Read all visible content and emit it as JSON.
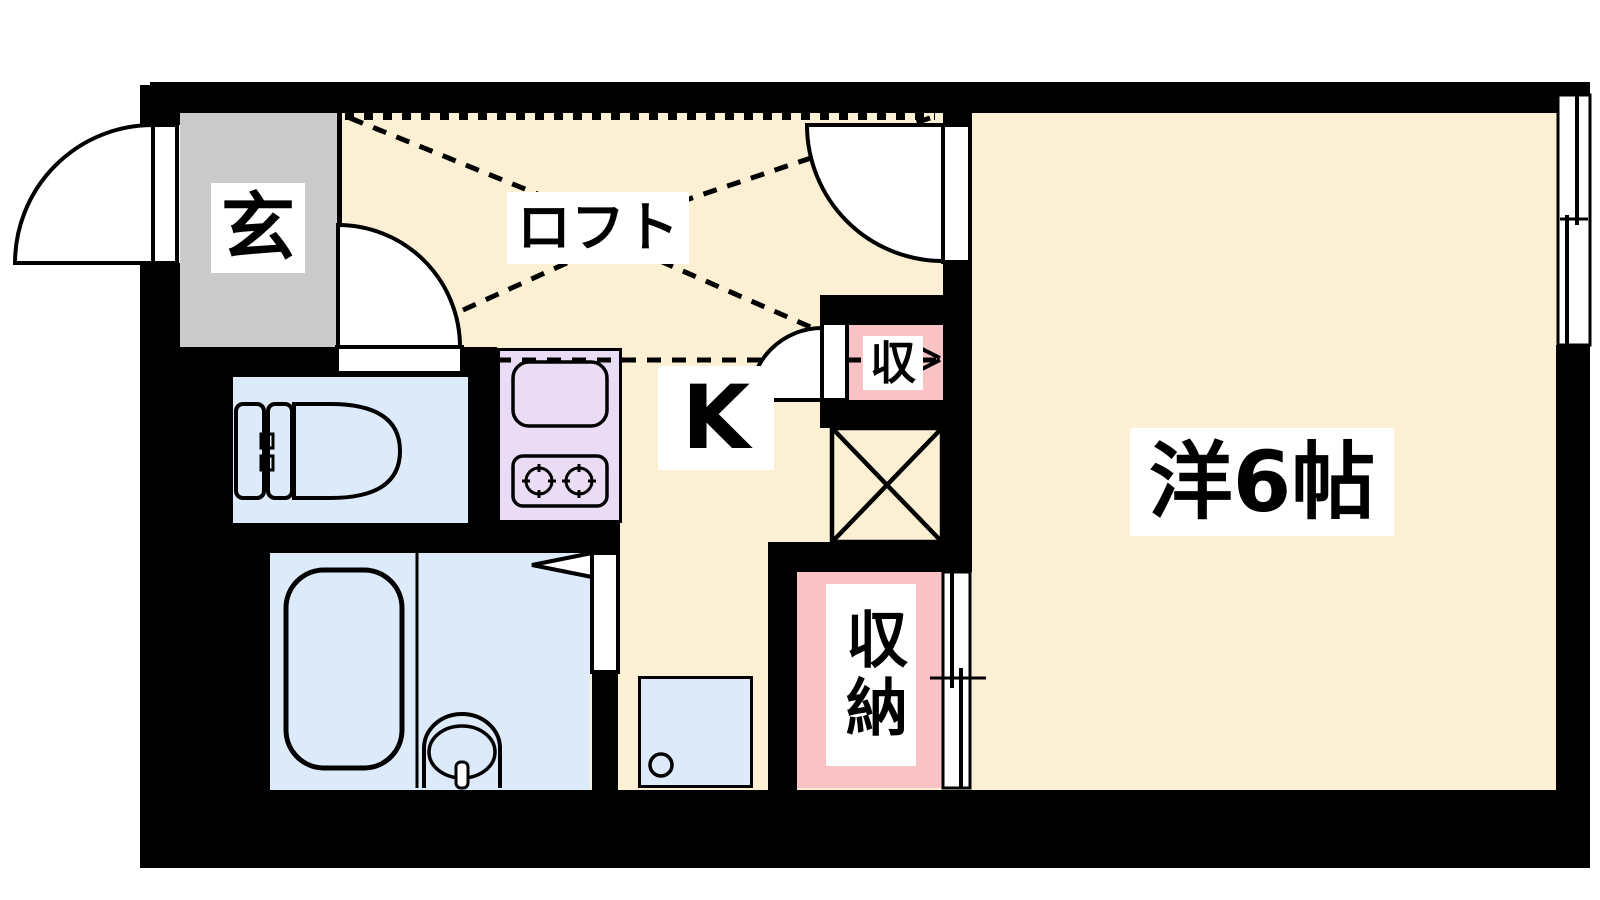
{
  "type": "japanese-apartment-floor-plan",
  "labels": {
    "entrance": "玄",
    "loft": "ロフト",
    "kitchen": "K",
    "storage_small": "収",
    "closet": "収納",
    "western_room": "洋6帖"
  },
  "icons": {
    "entrance_door": "outward-swing-door",
    "hall_door": "swing-door",
    "loft_room_door": "swing-door",
    "storage_small_door": "swing-door",
    "bathroom_door": "swing-door-triangle",
    "toilet": "toilet",
    "bathtub": "bathtub",
    "washbasin": "washbasin",
    "kitchen_sink": "sink",
    "stove": "two-burner-stove",
    "washer_pan": "washing-machine-pan-with-drain",
    "laundry_space": "x-box",
    "window": "sliding-window",
    "closet_door": "sliding-closet-door",
    "loft_extent": "dashed-outline"
  },
  "palette": {
    "wall": "#000000",
    "floor_cream": "#FBF0D3",
    "entrance_gray": "#CBCBCB",
    "wet_area_blue": "#DCEAFA",
    "kitchen_lavender": "#E9DCF4",
    "storage_pink": "#F9C3C6",
    "label_bg": "#FFFFFF",
    "line": "#000000"
  }
}
